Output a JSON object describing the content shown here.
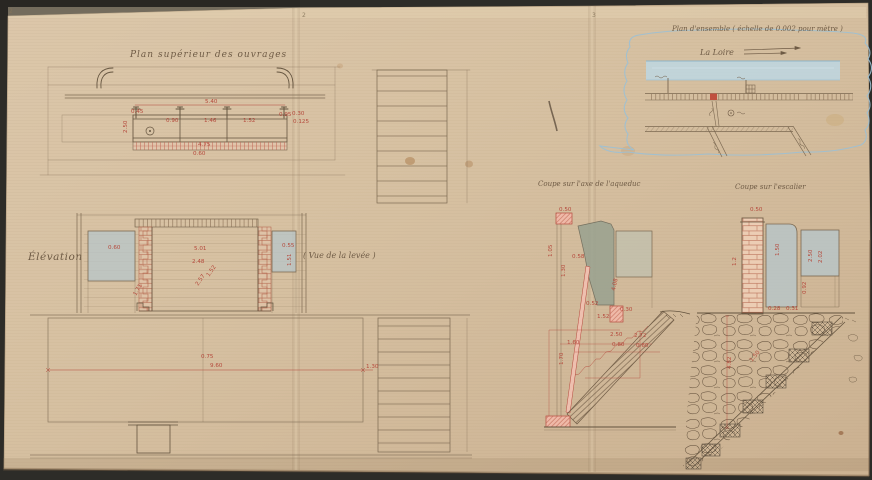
{
  "labels": {
    "plan_sup": "Plan supérieur des ouvrages",
    "elevation": "Élévation",
    "elevation_note": "( Vue de la levée )",
    "coupe_axe": "Coupe sur l'axe de l'aqueduc",
    "coupe_escalier": "Coupe sur l'escalier",
    "map_title": "Plan d'ensemble ( échelle de 0.002 pour mètre )",
    "map_river": "La Loire"
  },
  "page_marks": {
    "left": "2",
    "fold1": "2",
    "fold2": "3"
  },
  "colors": {
    "background": "#2d2c28",
    "paper": "#d7c1a3",
    "ink": "#7b6850",
    "red_ink": "#b5493c",
    "blue_wash": "#b7c5c9",
    "river_blue": "#bdd7e3",
    "brick_pink": "#eccdb4"
  },
  "dimensions": [
    {
      "t": "5.40",
      "x": 205,
      "y": 103
    },
    {
      "t": "0.45",
      "x": 131,
      "y": 113
    },
    {
      "t": "0.90",
      "x": 166,
      "y": 122
    },
    {
      "t": "1.46",
      "x": 204,
      "y": 122
    },
    {
      "t": "1.52",
      "x": 243,
      "y": 122
    },
    {
      "t": "0.95",
      "x": 279,
      "y": 116
    },
    {
      "t": "0.30",
      "x": 292,
      "y": 115
    },
    {
      "t": "0.125",
      "x": 293,
      "y": 123
    },
    {
      "t": "4.75",
      "x": 198,
      "y": 146
    },
    {
      "t": "0.60",
      "x": 193,
      "y": 155
    },
    {
      "t": "2.50",
      "x": 127,
      "y": 133,
      "r": -90
    },
    {
      "t": "0.60",
      "x": 108,
      "y": 249
    },
    {
      "t": "5.01",
      "x": 194,
      "y": 250
    },
    {
      "t": "2.48",
      "x": 192,
      "y": 263
    },
    {
      "t": "1.52",
      "x": 209,
      "y": 277,
      "r": -55
    },
    {
      "t": "2.57",
      "x": 198,
      "y": 286,
      "r": -55
    },
    {
      "t": "0.55",
      "x": 282,
      "y": 247
    },
    {
      "t": "1.51",
      "x": 291,
      "y": 266,
      "r": -90
    },
    {
      "t": "1.71",
      "x": 136,
      "y": 296,
      "r": -60
    },
    {
      "t": "9.60",
      "x": 210,
      "y": 367
    },
    {
      "t": "0.75",
      "x": 201,
      "y": 358
    },
    {
      "t": "1.30",
      "x": 366,
      "y": 368
    },
    {
      "t": "0.50",
      "x": 559,
      "y": 211
    },
    {
      "t": "1.05",
      "x": 552,
      "y": 257,
      "r": -90
    },
    {
      "t": "0.58",
      "x": 572,
      "y": 258
    },
    {
      "t": "1.30",
      "x": 565,
      "y": 277,
      "r": -90
    },
    {
      "t": "4.08",
      "x": 615,
      "y": 291,
      "r": -78
    },
    {
      "t": "0.52",
      "x": 586,
      "y": 305
    },
    {
      "t": "1.52",
      "x": 597,
      "y": 318
    },
    {
      "t": "0.30",
      "x": 620,
      "y": 311
    },
    {
      "t": "2.50",
      "x": 610,
      "y": 336
    },
    {
      "t": "0.80",
      "x": 612,
      "y": 346
    },
    {
      "t": "2.72",
      "x": 634,
      "y": 337
    },
    {
      "t": "0.60",
      "x": 636,
      "y": 347
    },
    {
      "t": "1.60",
      "x": 567,
      "y": 344
    },
    {
      "t": "1.70",
      "x": 563,
      "y": 365,
      "r": -90
    },
    {
      "t": "0.50",
      "x": 750,
      "y": 211
    },
    {
      "t": "1.2",
      "x": 736,
      "y": 266,
      "r": -90
    },
    {
      "t": "1.50",
      "x": 779,
      "y": 256,
      "r": -90
    },
    {
      "t": "2.50",
      "x": 812,
      "y": 262,
      "r": -90
    },
    {
      "t": "2.02",
      "x": 822,
      "y": 263,
      "r": -90
    },
    {
      "t": "0.92",
      "x": 806,
      "y": 294,
      "r": -90
    },
    {
      "t": "0.28",
      "x": 768,
      "y": 310
    },
    {
      "t": "0.31",
      "x": 786,
      "y": 310
    },
    {
      "t": "4.82",
      "x": 731,
      "y": 369,
      "r": -90
    },
    {
      "t": "1.50",
      "x": 752,
      "y": 362,
      "r": -50
    }
  ]
}
